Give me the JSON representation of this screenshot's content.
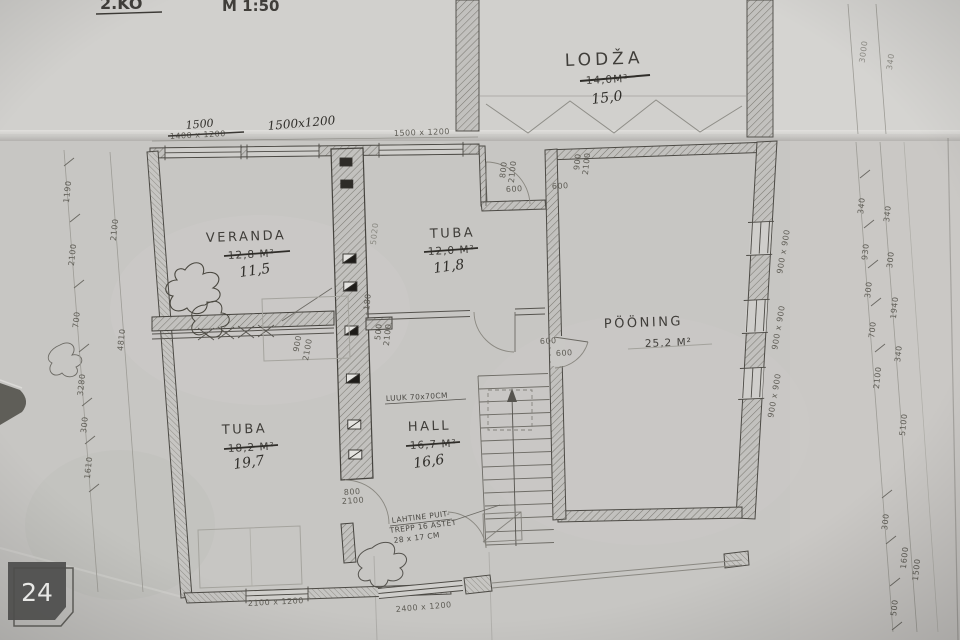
{
  "photo": {
    "badge": "24"
  },
  "titleblock": {
    "fragment": "2.KO",
    "scale": "M 1:50"
  },
  "rooms": {
    "lodza": {
      "name": "LODŽA",
      "old": "14,0M²",
      "new": "15,0"
    },
    "veranda": {
      "name": "VERANDA",
      "old": "12,8 M²",
      "new": "11,5"
    },
    "tuba_top": {
      "name": "TUBA",
      "old": "12,0 M²",
      "new": "11,8"
    },
    "pooning": {
      "name": "PÖÖNING",
      "area": "25,2 M²"
    },
    "tuba_bottom": {
      "name": "TUBA",
      "old": "18,2 M²",
      "new": "19,7"
    },
    "hall": {
      "name": "HALL",
      "old": "16,7 M²",
      "new": "16,6"
    }
  },
  "notes": {
    "luuk": "LUUK 70x70CM",
    "trepp_l1": "LAHTINE PUIT-",
    "trepp_l2": "TREPP 16 ASTET",
    "trepp_l3": "28 x 17 CM"
  },
  "dims": {
    "top": {
      "hand_total": "1500",
      "old_crossed": "1400 x 1200",
      "hand_window": "1500x1200",
      "window": "1500 x 1200"
    },
    "bottom": {
      "window_left": "2100 x 1200",
      "window_right": "2400 x 1200"
    },
    "left": [
      "1190",
      "2100",
      "700",
      "3280",
      "300",
      "1610",
      "2100",
      "4810"
    ],
    "right": [
      "340",
      "930",
      "300",
      "700",
      "2100",
      "300",
      "500",
      "340",
      "300",
      "1940",
      "340",
      "5100",
      "1600",
      "1500",
      "3000",
      "340"
    ],
    "right_window": "900 x 900",
    "doors": {
      "w800": "800",
      "w900": "900",
      "h2100": "2100",
      "w600": "600",
      "gap180": "180",
      "w500": "500",
      "stair": "5020"
    }
  }
}
